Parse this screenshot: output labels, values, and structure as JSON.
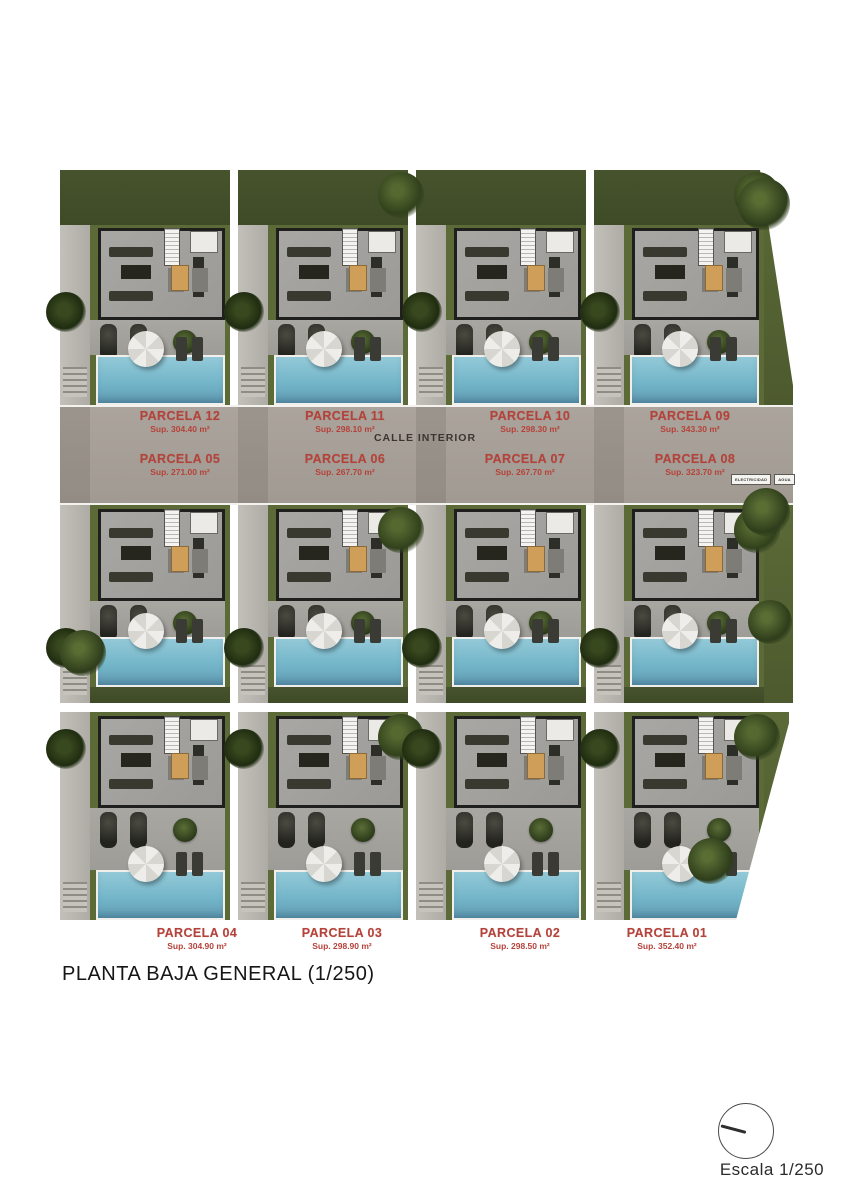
{
  "title": "PLANTA BAJA GENERAL (1/250)",
  "road": {
    "label": "CALLE INTERIOR"
  },
  "utilities": [
    {
      "label": "ELECTRICIDAD"
    },
    {
      "label": "AGUA"
    }
  ],
  "parcels": [
    {
      "name": "PARCELA 12",
      "area": "Sup. 304.40 m²"
    },
    {
      "name": "PARCELA 11",
      "area": "Sup. 298.10 m²"
    },
    {
      "name": "PARCELA 10",
      "area": "Sup. 298.30 m²"
    },
    {
      "name": "PARCELA 09",
      "area": "Sup. 343.30 m²"
    },
    {
      "name": "PARCELA 05",
      "area": "Sup. 271.00 m²"
    },
    {
      "name": "PARCELA 06",
      "area": "Sup. 267.70 m²"
    },
    {
      "name": "PARCELA 07",
      "area": "Sup. 267.70 m²"
    },
    {
      "name": "PARCELA 08",
      "area": "Sup. 323.70 m²"
    },
    {
      "name": "PARCELA 04",
      "area": "Sup. 304.90 m²"
    },
    {
      "name": "PARCELA 03",
      "area": "Sup. 298.90 m²"
    },
    {
      "name": "PARCELA 02",
      "area": "Sup. 298.50 m²"
    },
    {
      "name": "PARCELA 01",
      "area": "Sup. 352.40 m²"
    }
  ],
  "scale": {
    "label": "Escala 1/250"
  },
  "colors": {
    "accent_red": "#b5423a",
    "pool_blue": "#74b6c9",
    "lawn_green": "#5c6a38",
    "lawn_dark": "#47532c",
    "road_gray": "#a6a099",
    "floor_gray": "#a3a29e",
    "wall_black": "#1f1f1d"
  }
}
